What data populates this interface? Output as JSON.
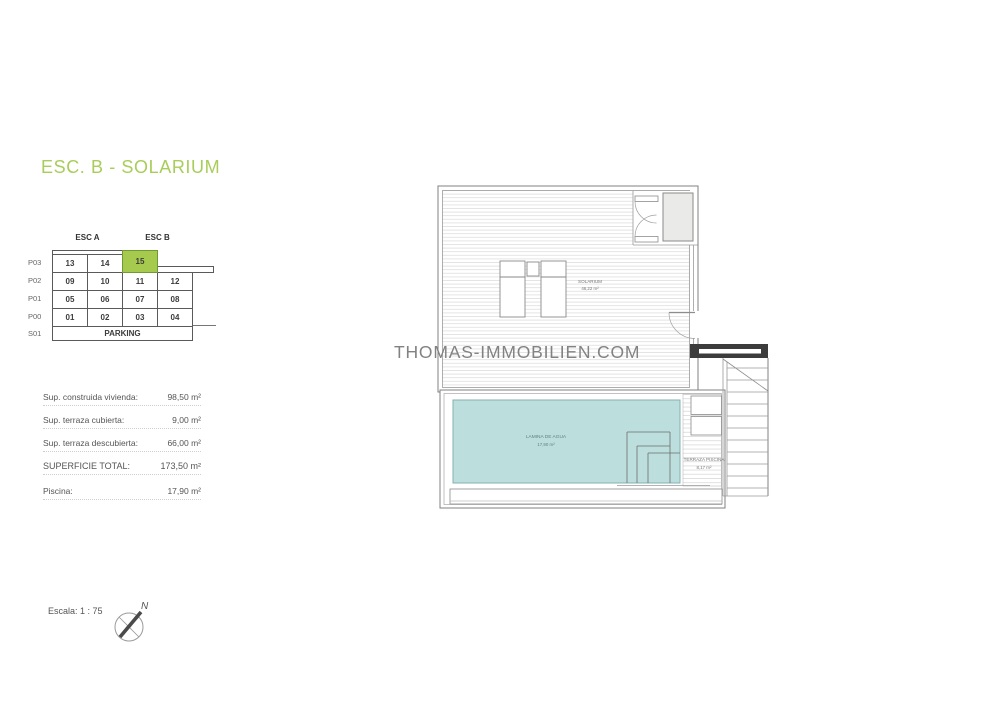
{
  "title": "ESC. B - SOLARIUM",
  "watermark": "THOMAS-IMMOBILIEN.COM",
  "colors": {
    "accent_green": "#a5ca4d",
    "accent_green_border": "#6f9a33",
    "pool_fill": "#bcdedd",
    "pool_border": "#84b2b0"
  },
  "level_table": {
    "esc_a": "ESC A",
    "esc_b": "ESC B",
    "highlighted_unit": "15",
    "rows": [
      {
        "label": "P03",
        "cells": [
          "13",
          "14",
          "15"
        ]
      },
      {
        "label": "P02",
        "cells": [
          "09",
          "10",
          "11",
          "12"
        ]
      },
      {
        "label": "P01",
        "cells": [
          "05",
          "06",
          "07",
          "08"
        ]
      },
      {
        "label": "P00",
        "cells": [
          "01",
          "02",
          "03",
          "04"
        ]
      }
    ],
    "parking_row_label": "S01",
    "parking": "PARKING"
  },
  "areas": {
    "rows": [
      {
        "label": "Sup. construida vivienda:",
        "value": "98,50 m²"
      },
      {
        "label": "Sup. terraza cubierta:",
        "value": "9,00 m²"
      },
      {
        "label": "Sup. terraza descubierta:",
        "value": "66,00 m²"
      },
      {
        "label": "SUPERFICIE TOTAL:",
        "value": "173,50 m²"
      },
      {
        "label": "Piscina:",
        "value": "17,90 m²"
      }
    ]
  },
  "plan": {
    "solarium_label": "SOLARIUM",
    "solarium_area": "46,22 m²",
    "pool_label": "LAMINA DE AGUA",
    "pool_area": "17,90 m²",
    "terrace_label": "TERRAZA PISCINA",
    "terrace_area": "8,17 m²"
  },
  "footer": {
    "scale": "Escala: 1 : 75",
    "north": "N"
  }
}
